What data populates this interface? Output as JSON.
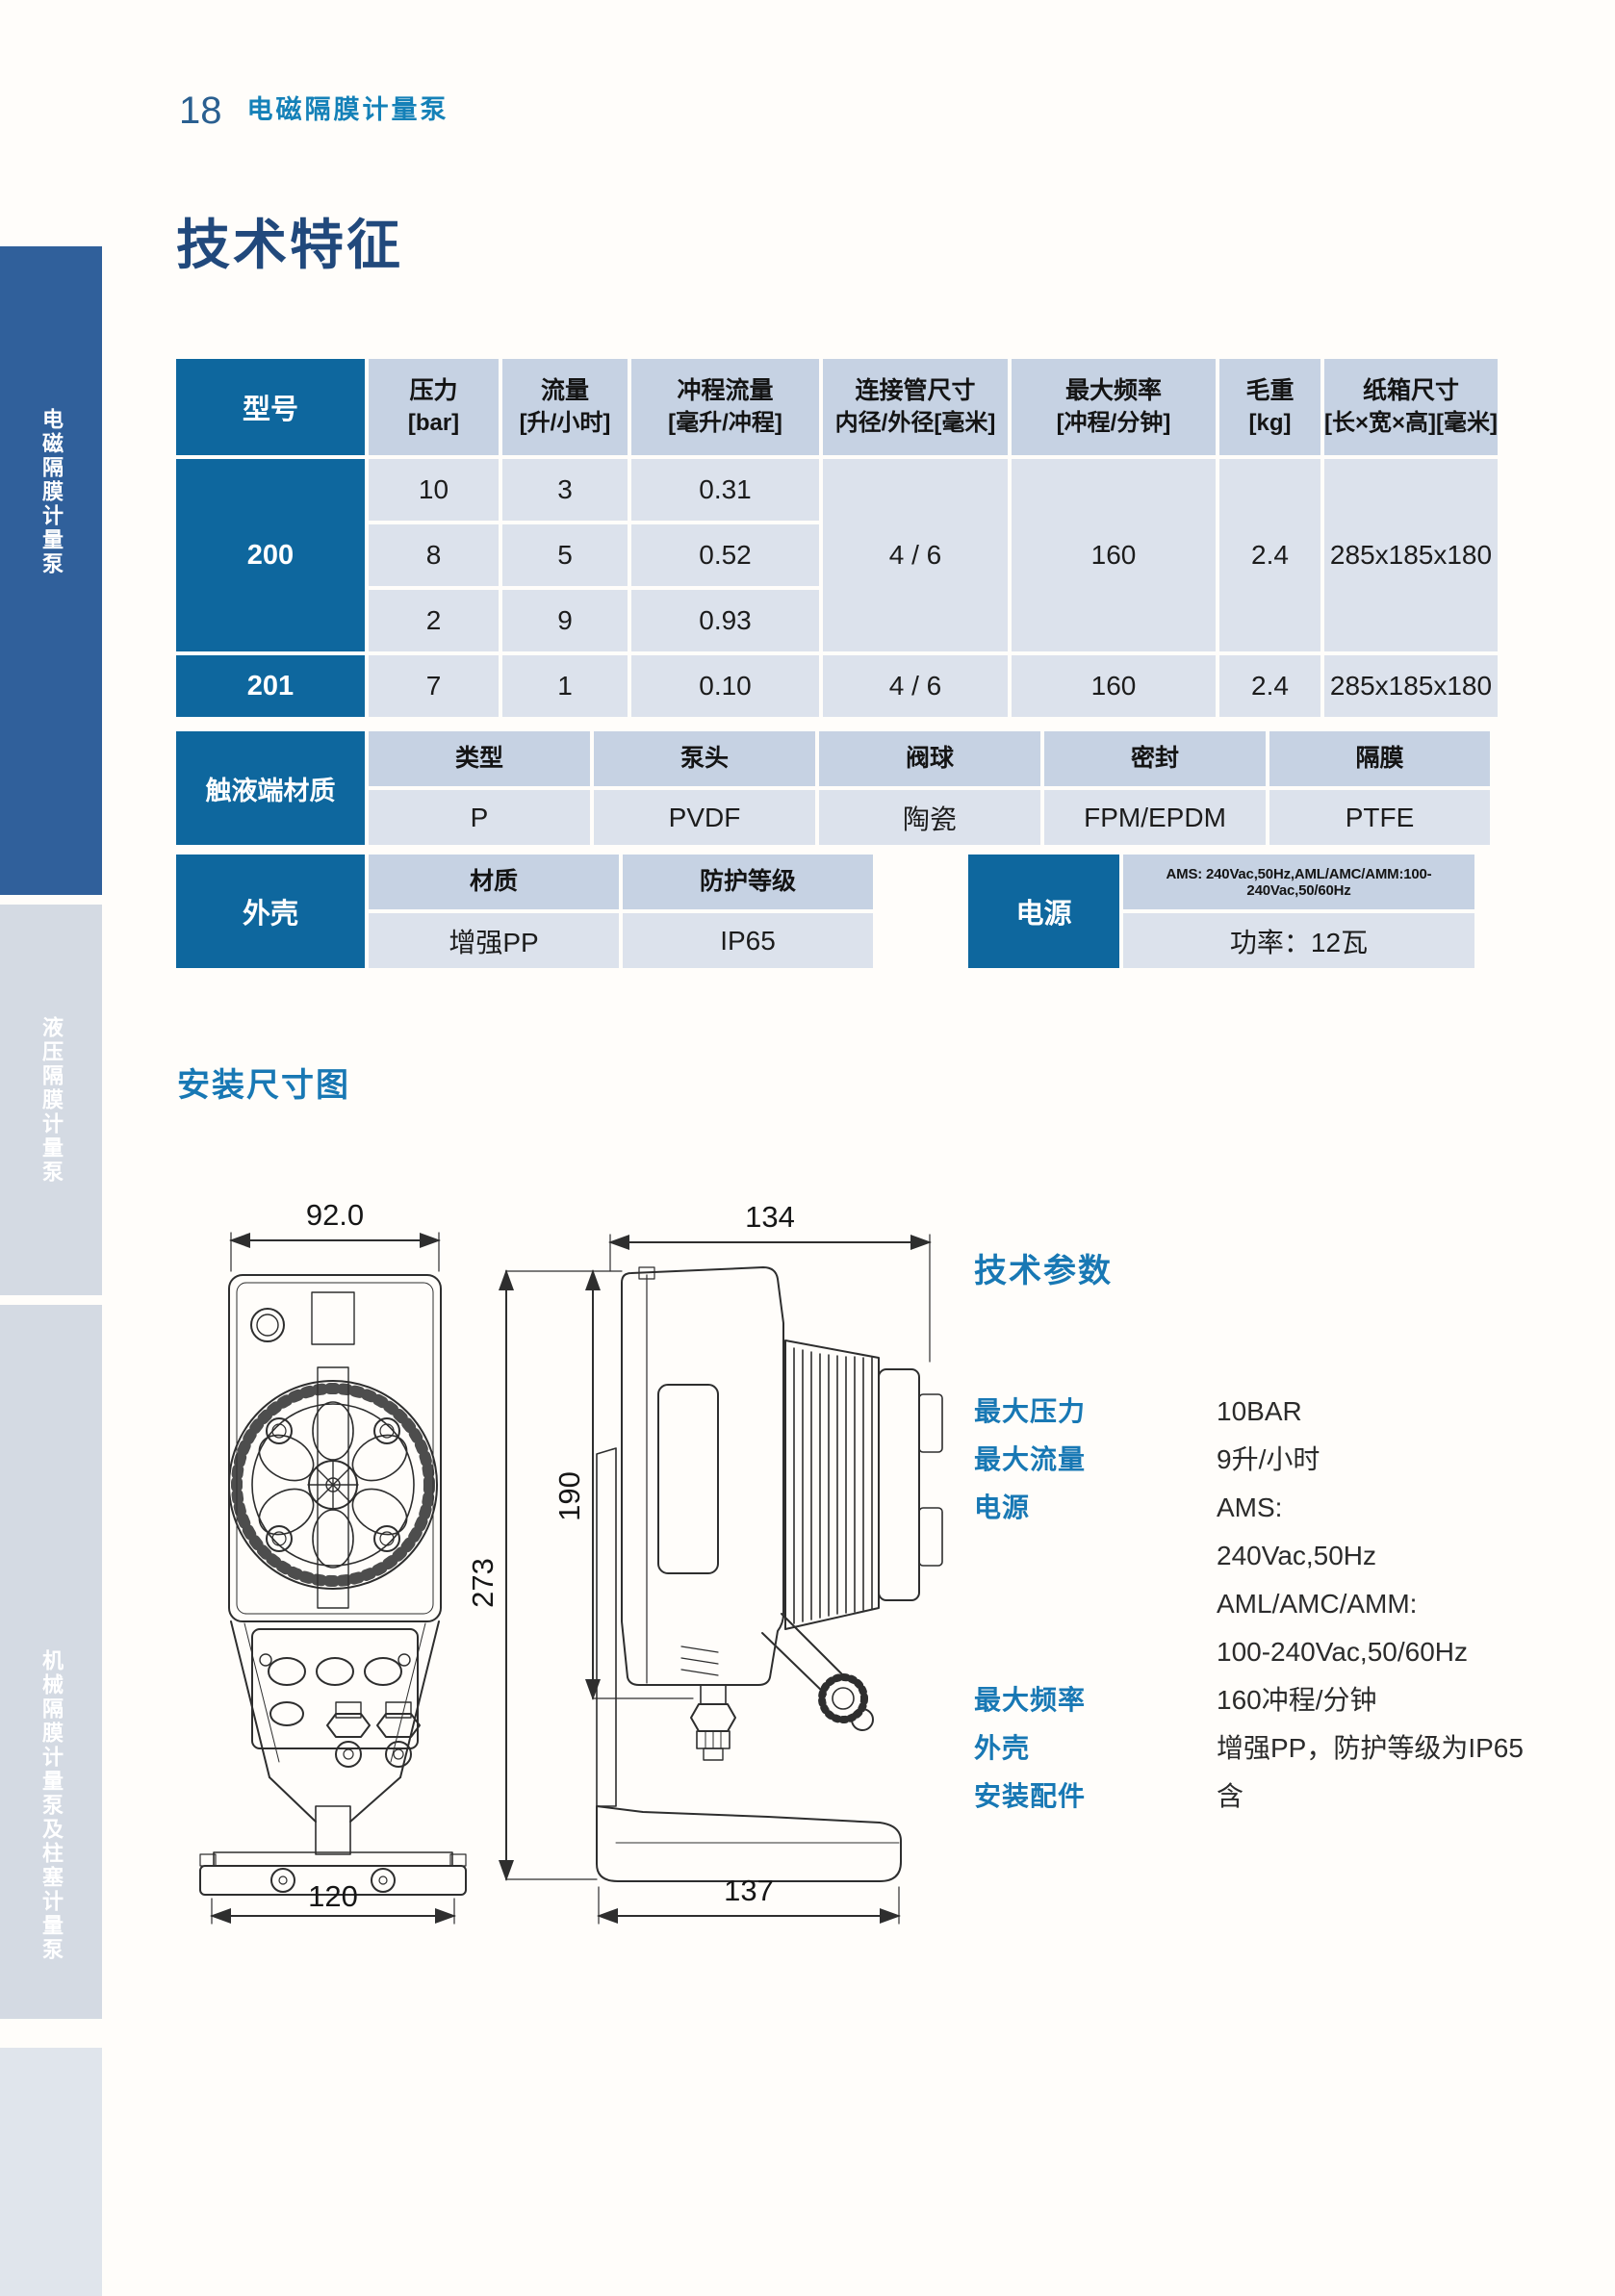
{
  "page": {
    "number": "18",
    "header": "电磁隔膜计量泵",
    "title": "技术特征"
  },
  "sidebar": {
    "tabs": [
      {
        "label": "电磁隔膜计量泵"
      },
      {
        "label": "液压隔膜计量泵"
      },
      {
        "label": "机械隔膜计量泵及柱塞计量泵"
      }
    ]
  },
  "spec_table": {
    "model_col": "型号",
    "columns": [
      {
        "label": "压力",
        "unit": "[bar]"
      },
      {
        "label": "流量",
        "unit": "[升/小时]"
      },
      {
        "label": "冲程流量",
        "unit": "[毫升/冲程]"
      },
      {
        "label": "连接管尺寸",
        "unit": "内径/外径[毫米]"
      },
      {
        "label": "最大频率",
        "unit": "[冲程/分钟]"
      },
      {
        "label": "毛重",
        "unit": "[kg]"
      },
      {
        "label": "纸箱尺寸",
        "unit": "[长×宽×高][毫米]"
      }
    ],
    "model_200": {
      "name": "200",
      "rows": [
        [
          "10",
          "3",
          "0.31"
        ],
        [
          "8",
          "5",
          "0.52"
        ],
        [
          "2",
          "9",
          "0.93"
        ]
      ],
      "pipe": "4 / 6",
      "freq": "160",
      "weight": "2.4",
      "carton": "285x185x180"
    },
    "model_201": {
      "name": "201",
      "pressure": "7",
      "flow": "1",
      "stroke": "0.10",
      "pipe": "4 / 6",
      "freq": "160",
      "weight": "2.4",
      "carton": "285x185x180"
    }
  },
  "materials_table": {
    "label": "触液端材质",
    "headers": [
      "类型",
      "泵头",
      "阀球",
      "密封",
      "隔膜"
    ],
    "values": [
      "P",
      "PVDF",
      "陶瓷",
      "FPM/EPDM",
      "PTFE"
    ]
  },
  "housing_table": {
    "label": "外壳",
    "headers": [
      "材质",
      "防护等级"
    ],
    "values": [
      "增强PP",
      "IP65"
    ]
  },
  "power_table": {
    "label": "电源",
    "spec_line": "AMS: 240Vac,50Hz,AML/AMC/AMM:100-240Vac,50/60Hz",
    "power_line": "功率：12瓦"
  },
  "drawing": {
    "title": "安装尺寸图",
    "front": {
      "top_width": "92.0",
      "base_width": "120"
    },
    "side": {
      "top_width": "134",
      "inner_height": "190",
      "total_height": "273",
      "base_width": "137"
    }
  },
  "tech_params": {
    "title": "技术参数",
    "items": [
      {
        "label": "最大压力",
        "value": "10BAR"
      },
      {
        "label": "最大流量",
        "value": "9升/小时"
      },
      {
        "label": "电源",
        "lines": [
          "AMS:",
          "240Vac,50Hz",
          "AML/AMC/AMM:",
          "100-240Vac,50/60Hz"
        ]
      },
      {
        "label": "最大频率",
        "value": "160冲程/分钟"
      },
      {
        "label": "外壳",
        "value": "增强PP，防护等级为IP65"
      },
      {
        "label": "安装配件",
        "value": "含"
      }
    ]
  },
  "colors": {
    "table_blue": "#0e679e",
    "header_cell": "#c6d2e3",
    "data_cell": "#dce2ec",
    "accent_blue": "#1878b4",
    "title_navy": "#21497c",
    "sidebar_active": "#30609b",
    "sidebar_inactive": "#d4dae3"
  }
}
